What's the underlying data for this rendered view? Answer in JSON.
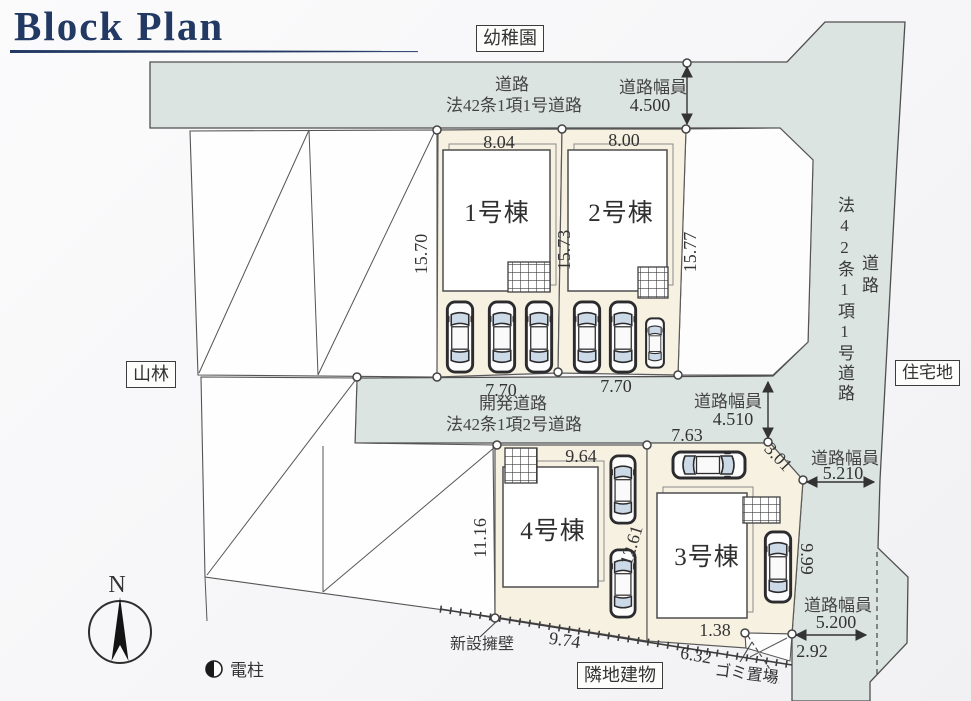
{
  "title": "Block Plan",
  "colors": {
    "road": "#dbe4e0",
    "lot": "#f7f1e1",
    "line": "#4c4c4c",
    "title_accent": "#223a63"
  },
  "boxes": {
    "kindergarten": "幼稚園",
    "forest": "山林",
    "residential": "住宅地",
    "neighbor": "隣地建物"
  },
  "roads": {
    "top": {
      "name": "道路",
      "law": "法42条1項1号道路",
      "width_label": "道路幅員",
      "width": "4.500"
    },
    "mid": {
      "name": "開発道路",
      "law": "法42条1項2号道路",
      "width_label": "道路幅員",
      "width": "4.510"
    },
    "right": {
      "name": "道路",
      "law": "法42条1項1号道路",
      "width_upper_label": "道路幅員",
      "width_upper": "5.210",
      "width_lower_label": "道路幅員",
      "width_lower": "5.200"
    }
  },
  "buildings": {
    "b1": "1号棟",
    "b2": "2号棟",
    "b3": "3号棟",
    "b4": "4号棟"
  },
  "dims": {
    "lot1_top": "8.04",
    "lot2_top": "8.00",
    "lot1_left": "15.70",
    "lot12_mid": "15.73",
    "lot2_right": "15.77",
    "lot1_bot": "7.70",
    "lot2_bot": "7.70",
    "lot4_top": "9.64",
    "lot4_left": "11.16",
    "lot4_right": "12.61",
    "lot3_top": "7.63",
    "lot3_chamfer": "3.01",
    "lot3_right": "9.99",
    "lot3_step": "1.38",
    "lot3_bot": "6.32",
    "road_corner": "2.92",
    "wall": "9.74"
  },
  "annotations": {
    "new_wall": "新設擁壁",
    "garbage": "ゴミ置場",
    "pole": "電柱",
    "north": "N"
  }
}
